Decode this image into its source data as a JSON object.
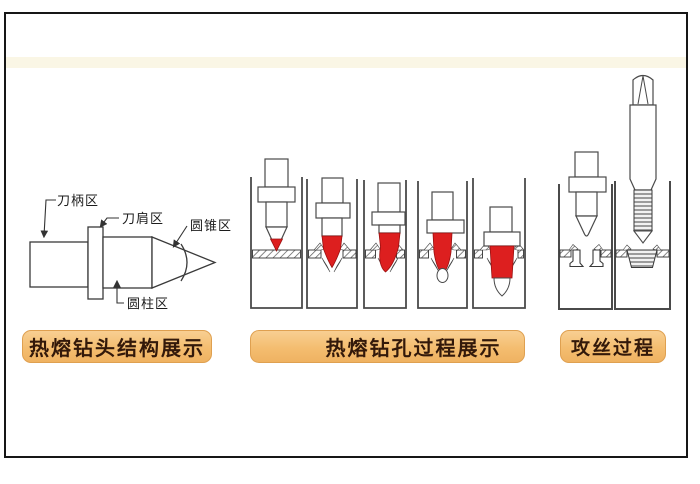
{
  "sections": {
    "structure": {
      "caption": "热熔钻头结构展示",
      "part_labels": {
        "shank": "刀柄区",
        "shoulder": "刀肩区",
        "cone": "圆锥区",
        "cylinder": "圆柱区"
      }
    },
    "drilling": {
      "caption": "热熔钻孔过程展示"
    },
    "tapping": {
      "caption": "攻丝过程"
    }
  },
  "colors": {
    "hot_red": "#dd1f1f",
    "caption_bg": "#f5c17b",
    "caption_border": "#dfa050",
    "caption_text": "#33190a",
    "line": "#4a4a4a"
  }
}
